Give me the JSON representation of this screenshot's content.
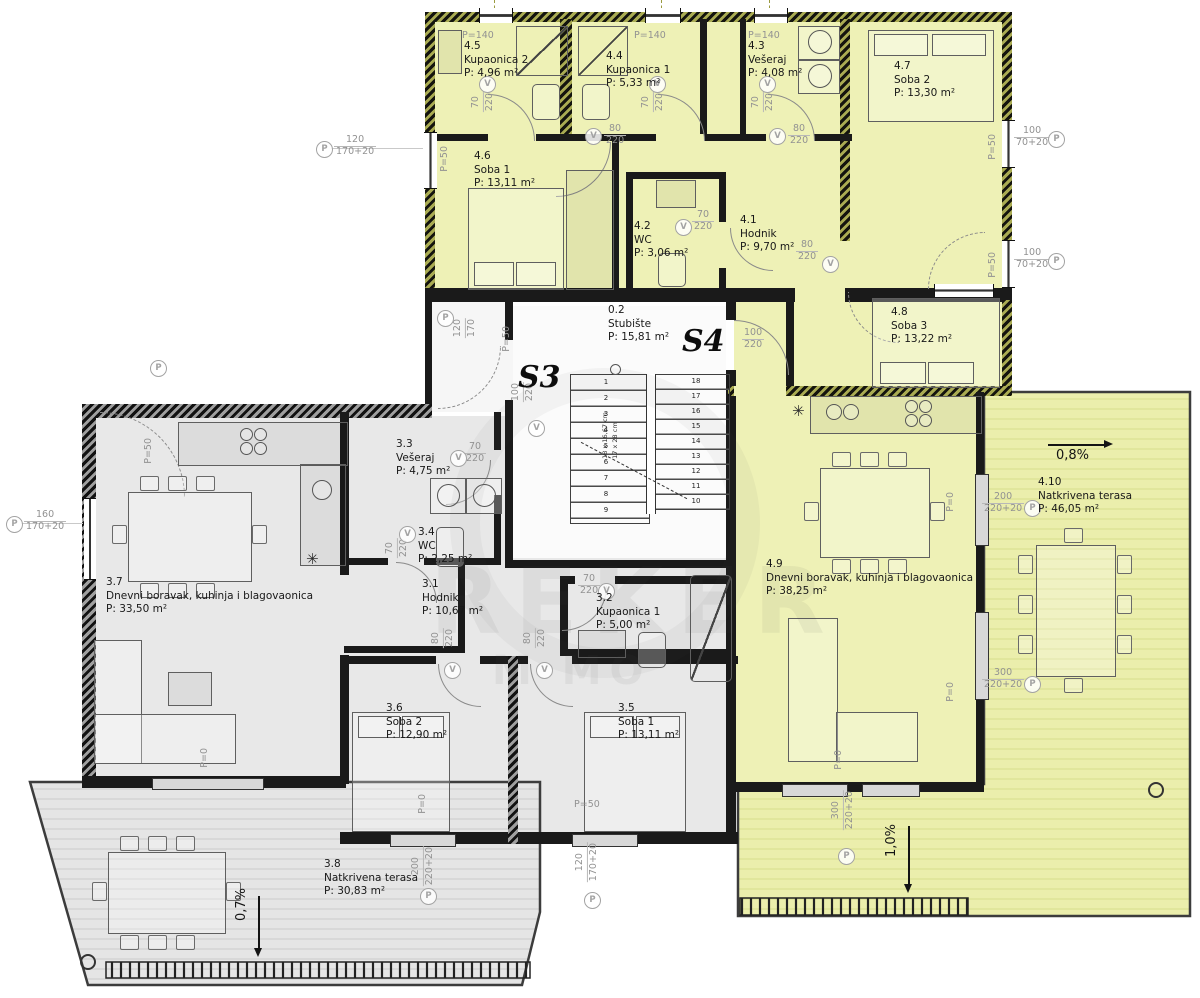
{
  "plan": {
    "apartment_s3_label": "S3",
    "apartment_s4_label": "S4"
  },
  "rooms": [
    {
      "id": "4.5",
      "name": "Kupaonica 2",
      "area": "P: 4,96 m²"
    },
    {
      "id": "4.4",
      "name": "Kupaonica 1",
      "area": "P: 5,33 m²"
    },
    {
      "id": "4.3",
      "name": "Vešeraj",
      "area": "P: 4,08 m²"
    },
    {
      "id": "4.7",
      "name": "Soba 2",
      "area": "P: 13,30 m²"
    },
    {
      "id": "4.6",
      "name": "Soba 1",
      "area": "P: 13,11 m²"
    },
    {
      "id": "4.2",
      "name": "WC",
      "area": "P: 3,06 m²"
    },
    {
      "id": "4.1",
      "name": "Hodnik",
      "area": "P: 9,70 m²"
    },
    {
      "id": "4.8",
      "name": "Soba 3",
      "area": "P: 13,22 m²"
    },
    {
      "id": "4.9",
      "name": "Dnevni boravak, kuhinja i blagovaonica",
      "area": "P: 38,25 m²"
    },
    {
      "id": "4.10",
      "name": "Natkrivena terasa",
      "area": "P: 46,05 m²"
    },
    {
      "id": "0.2",
      "name": "Stubište",
      "area": "P: 15,81 m²"
    },
    {
      "id": "3.3",
      "name": "Vešeraj",
      "area": "P: 4,75 m²"
    },
    {
      "id": "3.4",
      "name": "WC",
      "area": "P: 2,25 m²"
    },
    {
      "id": "3.7",
      "name": "Dnevni boravak, kuhinja i blagovaonica",
      "area": "P: 33,50 m²"
    },
    {
      "id": "3.1",
      "name": "Hodnik",
      "area": "P: 10,67 m²"
    },
    {
      "id": "3.2",
      "name": "Kupaonica 1",
      "area": "P: 5,00 m²"
    },
    {
      "id": "3.6",
      "name": "Soba 2",
      "area": "P: 12,90 m²"
    },
    {
      "id": "3.5",
      "name": "Soba 1",
      "area": "P: 13,11 m²"
    },
    {
      "id": "3.8",
      "name": "Natkrivena terasa",
      "area": "P: 30,83 m²"
    }
  ],
  "slopes": [
    {
      "label": "0,8%"
    },
    {
      "label": "1,0%"
    },
    {
      "label": "0,7%"
    }
  ],
  "dims": [
    {
      "l1": "P=140"
    },
    {
      "l1": "P=140"
    },
    {
      "l1": "P=140"
    },
    {
      "l1": "120",
      "l2": "170+20"
    },
    {
      "l1": "P=50"
    },
    {
      "l1": "70",
      "l2": "220"
    },
    {
      "l1": "70",
      "l2": "220"
    },
    {
      "l1": "70",
      "l2": "220"
    },
    {
      "l1": "80",
      "l2": "220"
    },
    {
      "l1": "80",
      "l2": "220"
    },
    {
      "l1": "70",
      "l2": "220"
    },
    {
      "l1": "80",
      "l2": "220"
    },
    {
      "l1": "100",
      "l2": "70+20"
    },
    {
      "l1": "100",
      "l2": "70+20"
    },
    {
      "l1": "P=50"
    },
    {
      "l1": "P=50"
    },
    {
      "l1": "120",
      "l2": "170"
    },
    {
      "l1": "P=50"
    },
    {
      "l1": "100",
      "l2": "220"
    },
    {
      "l1": "160",
      "l2": "170+20"
    },
    {
      "l1": "P=50"
    },
    {
      "l1": "100",
      "l2": "220"
    },
    {
      "l1": "70",
      "l2": "220"
    },
    {
      "l1": "70",
      "l2": "220"
    },
    {
      "l1": "70",
      "l2": "220"
    },
    {
      "l1": "80",
      "l2": "220"
    },
    {
      "l1": "80",
      "l2": "220"
    },
    {
      "l1": "200",
      "l2": "220+20"
    },
    {
      "l1": "300",
      "l2": "220+20"
    },
    {
      "l1": "300",
      "l2": "220+20"
    },
    {
      "l1": "200",
      "l2": "220+20"
    },
    {
      "l1": "120",
      "l2": "170+20"
    },
    {
      "l1": "P=50"
    },
    {
      "l1": "P=0"
    },
    {
      "l1": "P=0"
    },
    {
      "l1": "P=0"
    },
    {
      "l1": "P=0"
    },
    {
      "l1": "P=0"
    }
  ],
  "stairs": {
    "note_risers": "18 x 16,67 cm",
    "note_treads": "17 x 28 cm",
    "flight1": [
      "1",
      "2",
      "3",
      "4",
      "5",
      "6",
      "7",
      "8",
      "9"
    ],
    "flight2": [
      "18",
      "17",
      "16",
      "15",
      "14",
      "13",
      "12",
      "11",
      "10"
    ]
  },
  "symbols": {
    "p": "P",
    "v": "V",
    "asterisk": "✳"
  },
  "watermark": {
    "line1": "REKER",
    "line2": "M MO"
  },
  "colors": {
    "s4_fill": "#eef1b6",
    "s4_terrace": "#ebeeac",
    "s3_fill": "#e8e8e8",
    "s3_terrace": "#e6e6e6",
    "wall": "#1a1a1a",
    "dim_text": "#8f8f8f"
  }
}
